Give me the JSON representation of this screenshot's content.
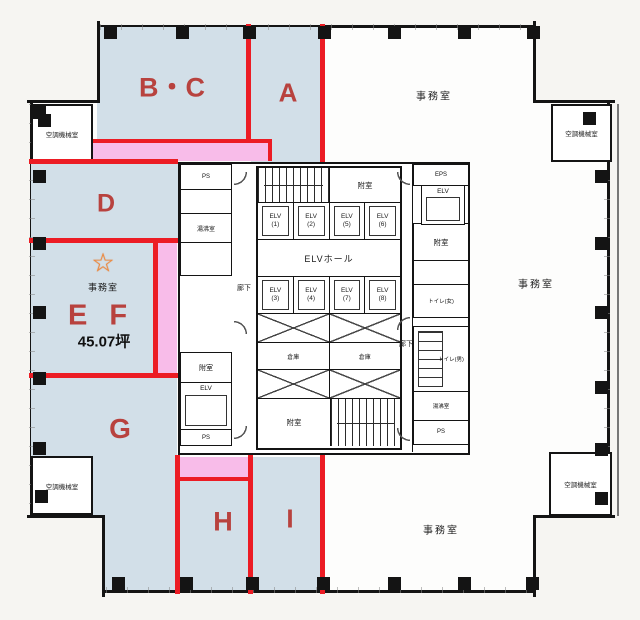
{
  "colors": {
    "zone_fill": "#d2dfe8",
    "highlight_pink": "#f8bce9",
    "line_red": "#ec1c24",
    "letter_red": "#b8423e",
    "wall_black": "#141414",
    "star_orange": "#f08a3c",
    "background": "#f6f5f2"
  },
  "zones": {
    "bc": "B・C",
    "a": "A",
    "d": "D",
    "ef": "E F",
    "g": "G",
    "h": "H",
    "i": "I"
  },
  "ef_unit": {
    "star": "☆",
    "room": "事務室",
    "area": "45.07坪"
  },
  "offices": {
    "top_right": "事務室",
    "right": "事務室",
    "bottom_right": "事務室"
  },
  "machine_room_label": "空調機械室",
  "core": {
    "corridor": "廊下",
    "elv_hall": "ELVホール",
    "elevators_top": [
      {
        "n": "ELV",
        "c": "(1)"
      },
      {
        "n": "ELV",
        "c": "(2)"
      },
      {
        "n": "ELV",
        "c": "(5)"
      },
      {
        "n": "ELV",
        "c": "(6)"
      }
    ],
    "elevators_bottom": [
      {
        "n": "ELV",
        "c": "(3)"
      },
      {
        "n": "ELV",
        "c": "(4)"
      },
      {
        "n": "ELV",
        "c": "(7)"
      },
      {
        "n": "ELV",
        "c": "(8)"
      }
    ],
    "vestibule": "附室",
    "elevator": "ELV",
    "storage": "倉庫",
    "toilet_women": "トイレ(女)",
    "toilet_men": "トイレ(男)",
    "hot_water": "湯沸室",
    "ps": "PS",
    "eps": "EPS"
  }
}
